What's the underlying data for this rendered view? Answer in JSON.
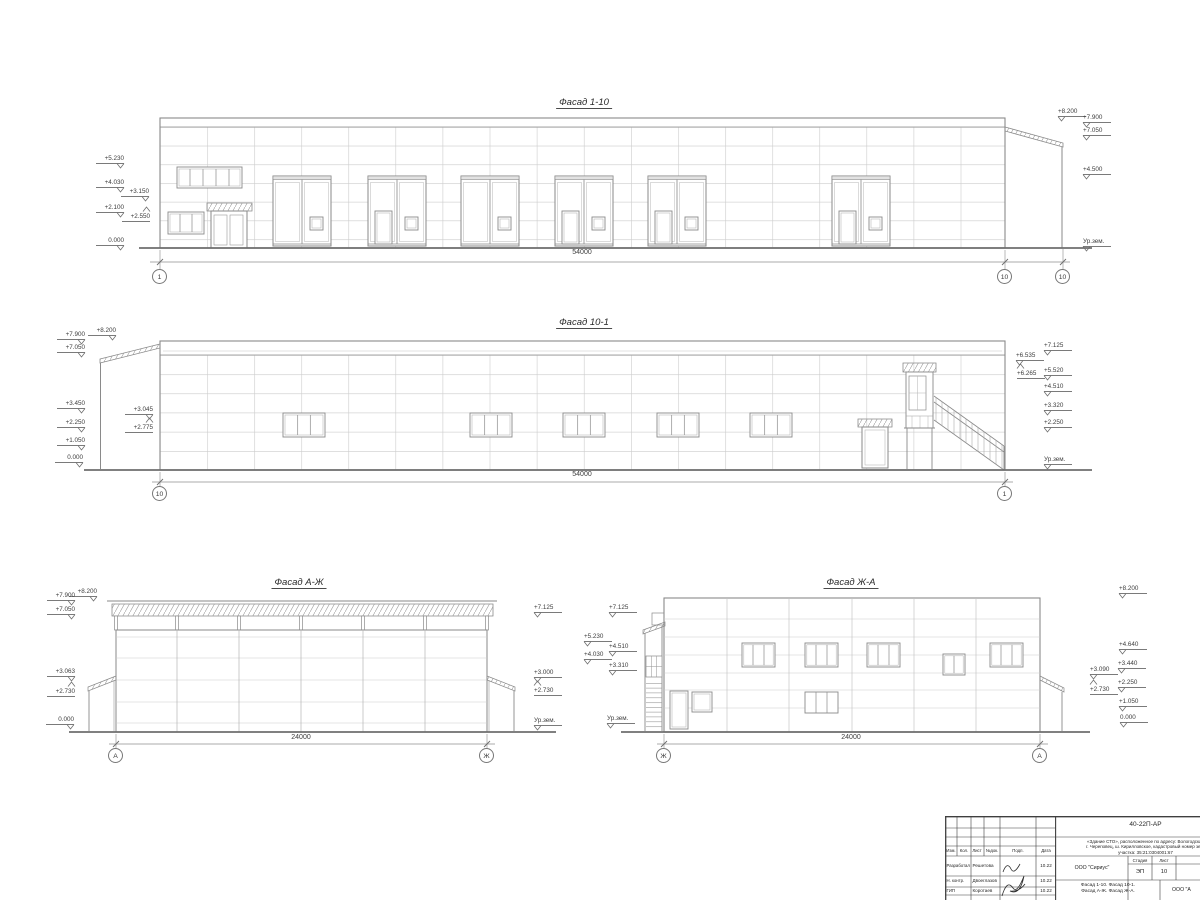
{
  "sheet": {
    "background": "#ffffff",
    "line_color": "#8a8a8a",
    "ground_color": "#6e6e6e",
    "text_color": "#3d3d3d"
  },
  "facades": {
    "f1": {
      "title": "Фасад 1-10",
      "title_pos": {
        "x": 584,
        "y": 97
      },
      "dim": "54000",
      "dim_pos": {
        "x": 582,
        "y": 249
      },
      "axes": [
        {
          "label": "1",
          "x": 160,
          "y": 277
        },
        {
          "label": "10",
          "x": 1005,
          "y": 277
        },
        {
          "label": "10",
          "x": 1063,
          "y": 277
        }
      ],
      "marks": [
        {
          "label": "+5.230",
          "x": 124,
          "y": 163,
          "side": "L"
        },
        {
          "label": "+4.030",
          "x": 124,
          "y": 187,
          "side": "L"
        },
        {
          "label": "+3.150",
          "x": 149,
          "y": 196,
          "side": "L"
        },
        {
          "label": "+2.100",
          "x": 124,
          "y": 212,
          "side": "L"
        },
        {
          "label": "+2.550",
          "x": 150,
          "y": 221,
          "side": "L",
          "flip": true
        },
        {
          "label": "0.000",
          "x": 124,
          "y": 245,
          "side": "L"
        },
        {
          "label": "+8.200",
          "x": 1058,
          "y": 116,
          "side": "R"
        },
        {
          "label": "+7.900",
          "x": 1083,
          "y": 122,
          "side": "R"
        },
        {
          "label": "+7.050",
          "x": 1083,
          "y": 135,
          "side": "R"
        },
        {
          "label": "+4.500",
          "x": 1083,
          "y": 174,
          "side": "R"
        },
        {
          "label": "Ур.зем.",
          "x": 1083,
          "y": 246,
          "side": "R"
        }
      ]
    },
    "f2": {
      "title": "Фасад 10-1",
      "title_pos": {
        "x": 584,
        "y": 317
      },
      "dim": "54000",
      "dim_pos": {
        "x": 582,
        "y": 471
      },
      "axes": [
        {
          "label": "10",
          "x": 160,
          "y": 494
        },
        {
          "label": "1",
          "x": 1005,
          "y": 494
        }
      ],
      "marks": [
        {
          "label": "+8.200",
          "x": 116,
          "y": 335,
          "side": "L"
        },
        {
          "label": "+7.900",
          "x": 85,
          "y": 339,
          "side": "L"
        },
        {
          "label": "+7.050",
          "x": 85,
          "y": 352,
          "side": "L"
        },
        {
          "label": "+3.450",
          "x": 85,
          "y": 408,
          "side": "L"
        },
        {
          "label": "+3.045",
          "x": 153,
          "y": 414,
          "side": "L"
        },
        {
          "label": "+2.775",
          "x": 153,
          "y": 432,
          "side": "L",
          "flip": true
        },
        {
          "label": "+2.250",
          "x": 85,
          "y": 427,
          "side": "L"
        },
        {
          "label": "+1.050",
          "x": 85,
          "y": 445,
          "side": "L"
        },
        {
          "label": "0.000",
          "x": 83,
          "y": 462,
          "side": "L"
        },
        {
          "label": "+7.125",
          "x": 1044,
          "y": 350,
          "side": "R"
        },
        {
          "label": "+6.535",
          "x": 1016,
          "y": 360,
          "side": "R"
        },
        {
          "label": "+6.265",
          "x": 1017,
          "y": 378,
          "side": "R",
          "flip": true
        },
        {
          "label": "+5.520",
          "x": 1044,
          "y": 375,
          "side": "R"
        },
        {
          "label": "+4.510",
          "x": 1044,
          "y": 391,
          "side": "R"
        },
        {
          "label": "+3.320",
          "x": 1044,
          "y": 410,
          "side": "R"
        },
        {
          "label": "+2.250",
          "x": 1044,
          "y": 427,
          "side": "R"
        },
        {
          "label": "Ур.зем.",
          "x": 1044,
          "y": 464,
          "side": "R"
        }
      ]
    },
    "f3": {
      "title": "Фасад А-Ж",
      "title_pos": {
        "x": 299,
        "y": 577
      },
      "dim": "24000",
      "dim_pos": {
        "x": 301,
        "y": 734
      },
      "axes": [
        {
          "label": "А",
          "x": 116,
          "y": 756
        },
        {
          "label": "Ж",
          "x": 487,
          "y": 756
        }
      ],
      "marks": [
        {
          "label": "+8.200",
          "x": 97,
          "y": 596,
          "side": "L"
        },
        {
          "label": "+7.900",
          "x": 75,
          "y": 600,
          "side": "L"
        },
        {
          "label": "+7.050",
          "x": 75,
          "y": 614,
          "side": "L"
        },
        {
          "label": "+3.063",
          "x": 75,
          "y": 676,
          "side": "L"
        },
        {
          "label": "+2.730",
          "x": 75,
          "y": 696,
          "side": "L",
          "flip": true
        },
        {
          "label": "0.000",
          "x": 74,
          "y": 724,
          "side": "L"
        },
        {
          "label": "+7.125",
          "x": 534,
          "y": 612,
          "side": "R"
        },
        {
          "label": "+3.000",
          "x": 534,
          "y": 677,
          "side": "R"
        },
        {
          "label": "+2.730",
          "x": 534,
          "y": 695,
          "side": "R",
          "flip": true
        },
        {
          "label": "Ур.зем.",
          "x": 534,
          "y": 725,
          "side": "R"
        }
      ]
    },
    "f4": {
      "title": "Фасад Ж-А",
      "title_pos": {
        "x": 851,
        "y": 577
      },
      "dim": "24000",
      "dim_pos": {
        "x": 851,
        "y": 734
      },
      "axes": [
        {
          "label": "Ж",
          "x": 664,
          "y": 756
        },
        {
          "label": "А",
          "x": 1040,
          "y": 756
        }
      ],
      "marks": [
        {
          "label": "+7.125",
          "x": 609,
          "y": 612,
          "side": "R"
        },
        {
          "label": "+5.230",
          "x": 584,
          "y": 641,
          "side": "R"
        },
        {
          "label": "+4.510",
          "x": 609,
          "y": 651,
          "side": "R"
        },
        {
          "label": "+4.030",
          "x": 584,
          "y": 659,
          "side": "R"
        },
        {
          "label": "+3.310",
          "x": 609,
          "y": 670,
          "side": "R"
        },
        {
          "label": "Ур.зем.",
          "x": 607,
          "y": 723,
          "side": "R"
        },
        {
          "label": "+8.200",
          "x": 1119,
          "y": 593,
          "side": "R"
        },
        {
          "label": "+4.640",
          "x": 1119,
          "y": 649,
          "side": "R"
        },
        {
          "label": "+3.440",
          "x": 1118,
          "y": 668,
          "side": "R"
        },
        {
          "label": "+3.090",
          "x": 1090,
          "y": 674,
          "side": "R"
        },
        {
          "label": "+2.250",
          "x": 1118,
          "y": 687,
          "side": "R"
        },
        {
          "label": "+2.730",
          "x": 1090,
          "y": 694,
          "side": "R",
          "flip": true
        },
        {
          "label": "+1.050",
          "x": 1119,
          "y": 706,
          "side": "R"
        },
        {
          "label": "0.000",
          "x": 1120,
          "y": 722,
          "side": "R"
        }
      ]
    }
  },
  "title_block": {
    "doc_number": "40-22П-АР",
    "project": [
      "«Здание СТО», расположенное по адресу: Вологодская",
      "г. Череповец, ш. Кирилловское, кадастровый номер зем.",
      "участка: 35:21:0304001:67"
    ],
    "columns": [
      "Изм.",
      "Кол.",
      "Лист",
      "№док.",
      "Подп.",
      "Дата"
    ],
    "people": [
      {
        "role": "Разработал",
        "name": "Решетова",
        "date": "10.22"
      },
      {
        "role": "Н. контр.",
        "name": "Двоеглазов",
        "date": "10.22"
      },
      {
        "role": "ГИП",
        "name": "Коротаев",
        "date": "10.22"
      }
    ],
    "org": "ООО \"Сириус\"",
    "stage_label": "Стадия",
    "sheet_label": "Лист",
    "stage_value": "ЭП",
    "sheet_value": "10",
    "content_lines": [
      "Фасад 1-10. Фасад 10-1.",
      "Фасад А-Ж. Фасад Ж-А."
    ],
    "org2": "ООО \"А"
  }
}
